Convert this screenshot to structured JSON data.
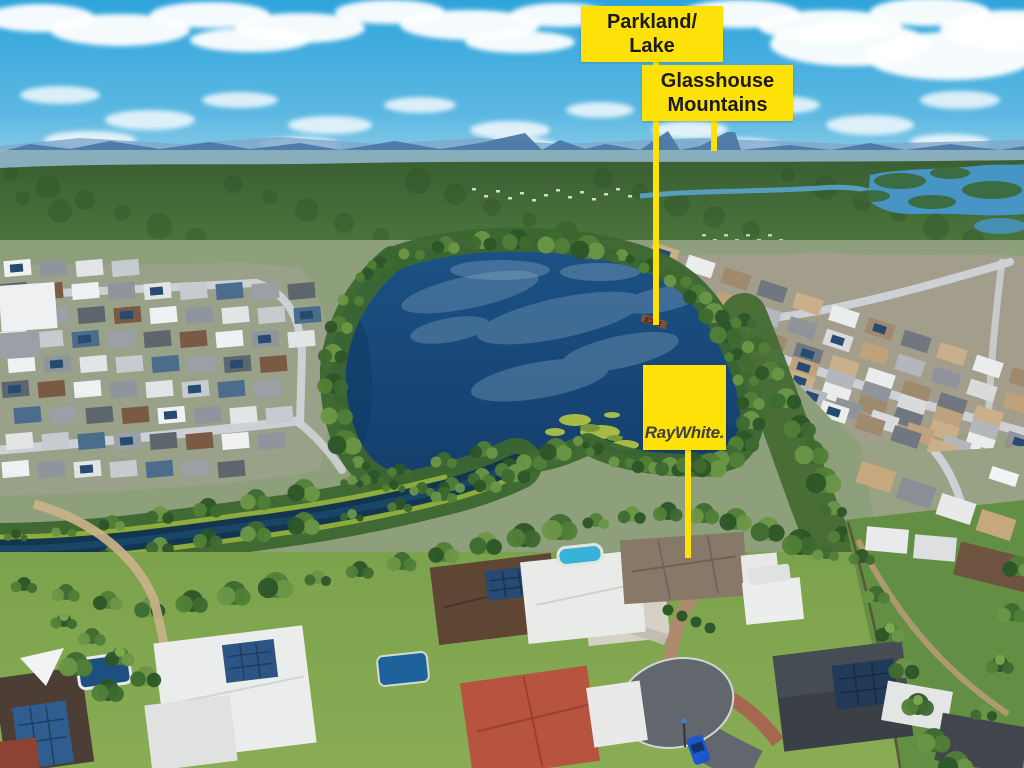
{
  "callouts": {
    "parkland": {
      "line1": "Parkland/",
      "line2": "Lake"
    },
    "mountains": {
      "line1": "Glasshouse",
      "line2": "Mountains"
    },
    "brand": {
      "text": "RayWhite."
    }
  },
  "colors": {
    "callout_bg": "#FFE10A",
    "callout_text": "#1B1B1B",
    "brand_text": "#3F3F3F"
  }
}
